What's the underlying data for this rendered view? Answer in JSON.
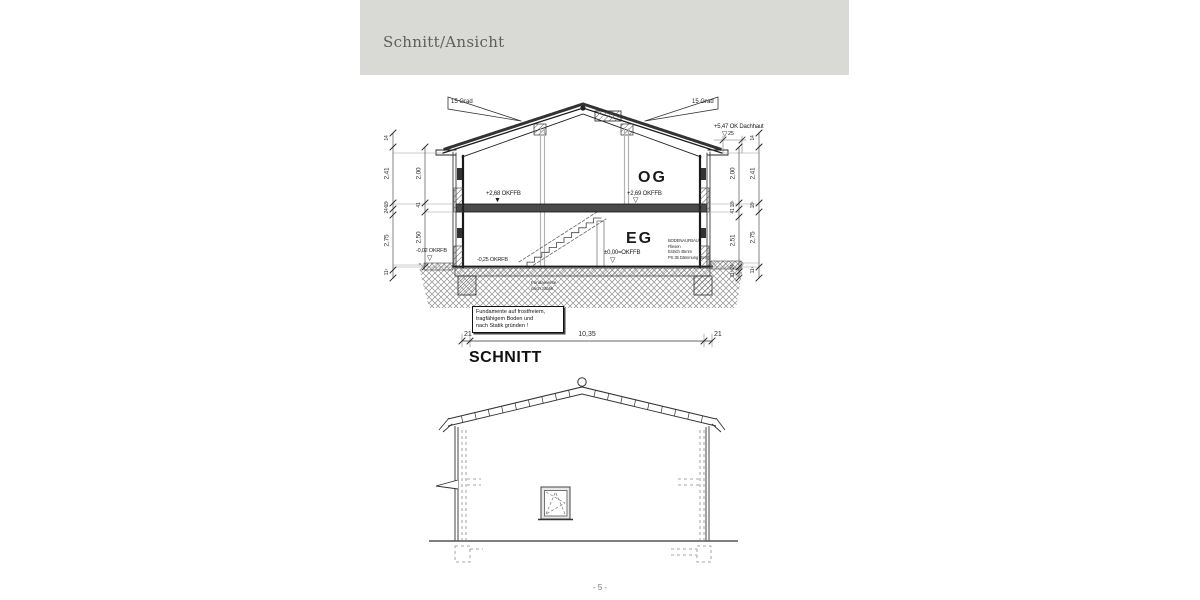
{
  "header": {
    "title": "Schnitt/Ansicht"
  },
  "page": {
    "number": "- 5 -"
  },
  "icons": {
    "level_open": "▽",
    "level_filled": "▼"
  },
  "section": {
    "title": "SCHNITT",
    "roof": {
      "slope_left": "15 Grad",
      "slope_right": "15 Grad",
      "ridge_level": "+5,47 OK Dachhaut",
      "eaves_dim": "25"
    },
    "rooms": {
      "og": "OG",
      "eg": "EG"
    },
    "levels": {
      "og_left": "+2,68 OKFFB",
      "og_right": "+2,69 OKFFB",
      "eg": "±0,00=OKFFB",
      "rfb_outside": "-0,02 OKRFB",
      "rfb_eg": "-0,25 OKRFB"
    },
    "floor_buildup": [
      "BODENAUFBAU",
      "Fliesen",
      "Estrich 45mm",
      "PS 35 Dämmung 35mm"
    ],
    "ground_note": [
      "Fundamente",
      "nach Statik"
    ],
    "note_box": [
      "Fundamente auf frostfreiem,",
      "tragfähigem Boden und",
      "nach Statik gründen !"
    ],
    "dims": {
      "left_outer": [
        "14",
        "2,41",
        "18¹",
        "24⁸",
        "2,75",
        "11⁹"
      ],
      "left_inner": [
        "2,00",
        "41",
        "2,50"
      ],
      "right_inner": [
        "2,00",
        "18¹",
        "41",
        "2,51",
        "24",
        "11⁵"
      ],
      "right_outer": [
        "14",
        "2,41",
        "18¹",
        "2,75",
        "11⁹"
      ],
      "bottom": [
        "21",
        "10,35",
        "21"
      ]
    }
  }
}
